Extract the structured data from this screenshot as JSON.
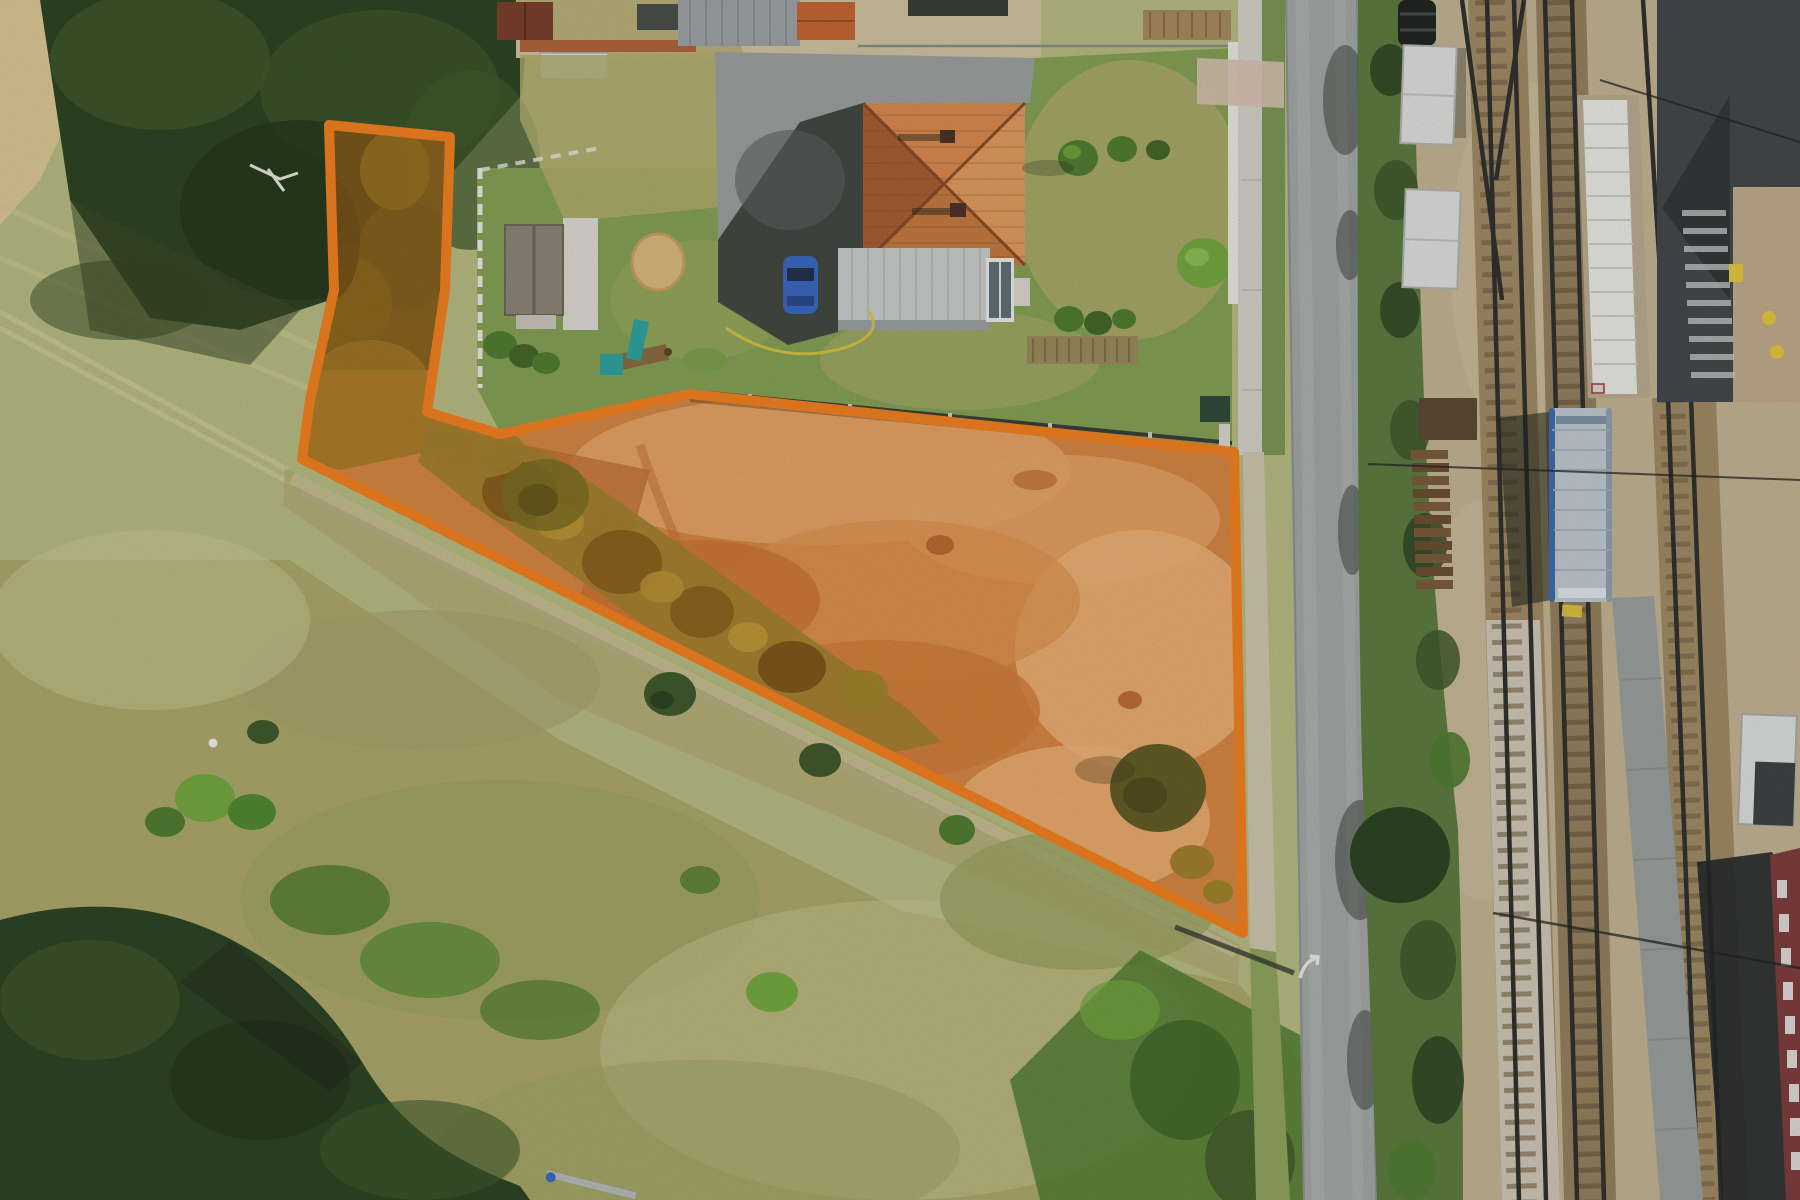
{
  "scene": {
    "description": "Aerial drone photograph of a building plot for sale, highlighted with a bright orange boundary overlay",
    "plot_overlay": {
      "boundary_color": "#f18020",
      "boundary_width_px": 10,
      "fill_tint": "rgba(238,112,16,0.20)"
    },
    "landmarks": [
      "wooded strip inside plot (top-left)",
      "large cleared orange-dirt parcel",
      "family house with orange hip roof",
      "flat gray annex roof with conservatory",
      "dark blue parked car",
      "garden cottage with gray roof and white patio",
      "round trimmed bushes and sandpit",
      "children playground with teal slide",
      "vertical asphalt road with white curve arrow marking",
      "railway yard with several tracks",
      "blue-and-silver train car",
      "white equipment containers and black tank",
      "stacked rail sleepers",
      "dark asphalt platform with tan section",
      "meadow, stubble field and forest patches"
    ]
  },
  "palette": {
    "outline": "#f18020",
    "tint": "rgba(238,112,16,0.20)",
    "field_pale": "#b7bb82",
    "field_light": "#c9c794",
    "stubble": "#dbc795",
    "meadow_tan": "#aca76b",
    "rough_grass": "#9ba163",
    "tree_dark": "#2d4423",
    "tree_mid": "#40592c",
    "bush_green": "#517c31",
    "bright_green": "#74a73f",
    "lawn": "#85a055",
    "lawn_dry": "#b2ab6d",
    "dirt_base": "#cf8c50",
    "dirt_light": "#e2b17c",
    "dirt_dark": "#b06c38",
    "dirt_pale": "#ecc392",
    "scrub_olive": "#8f8436",
    "scrub_brown": "#6e5a22",
    "asphalt_light": "#9aa09f",
    "asphalt_dark": "#3d4240",
    "road_gray": "#a2a7a5",
    "sidewalk": "#d2d0c6",
    "roof_orange": "#d8894f",
    "roof_orange_light": "#e09a5e",
    "roof_orange_dark": "#a85e33",
    "roof_ridge": "#7e4424",
    "annex_gray": "#c9cccb",
    "cottage_roof": "#8d8476",
    "patio_white": "#dcd9d1",
    "car_blue": "#3a68c0",
    "wall_white": "#e9e7e1",
    "gravel_tan": "#c3b392",
    "ballast_brown": "#a08a64",
    "ballast_pale": "#cfc6b5",
    "rail_dark": "#30312f",
    "platform_dark": "#43484a",
    "platform_tan": "#c0aa8b",
    "slab_white": "#e9e9e4",
    "train_silver": "#bfc9d1",
    "train_blue": "#3e6cae",
    "container_white": "#dddfdd",
    "tank_black": "#202523",
    "sleeper_brown": "#7b5c3b",
    "maroon": "#7e3d3c",
    "hedge_green": "#5d7b40",
    "marking_yellow": "#e3c63e",
    "shadow": "#1c231c"
  }
}
